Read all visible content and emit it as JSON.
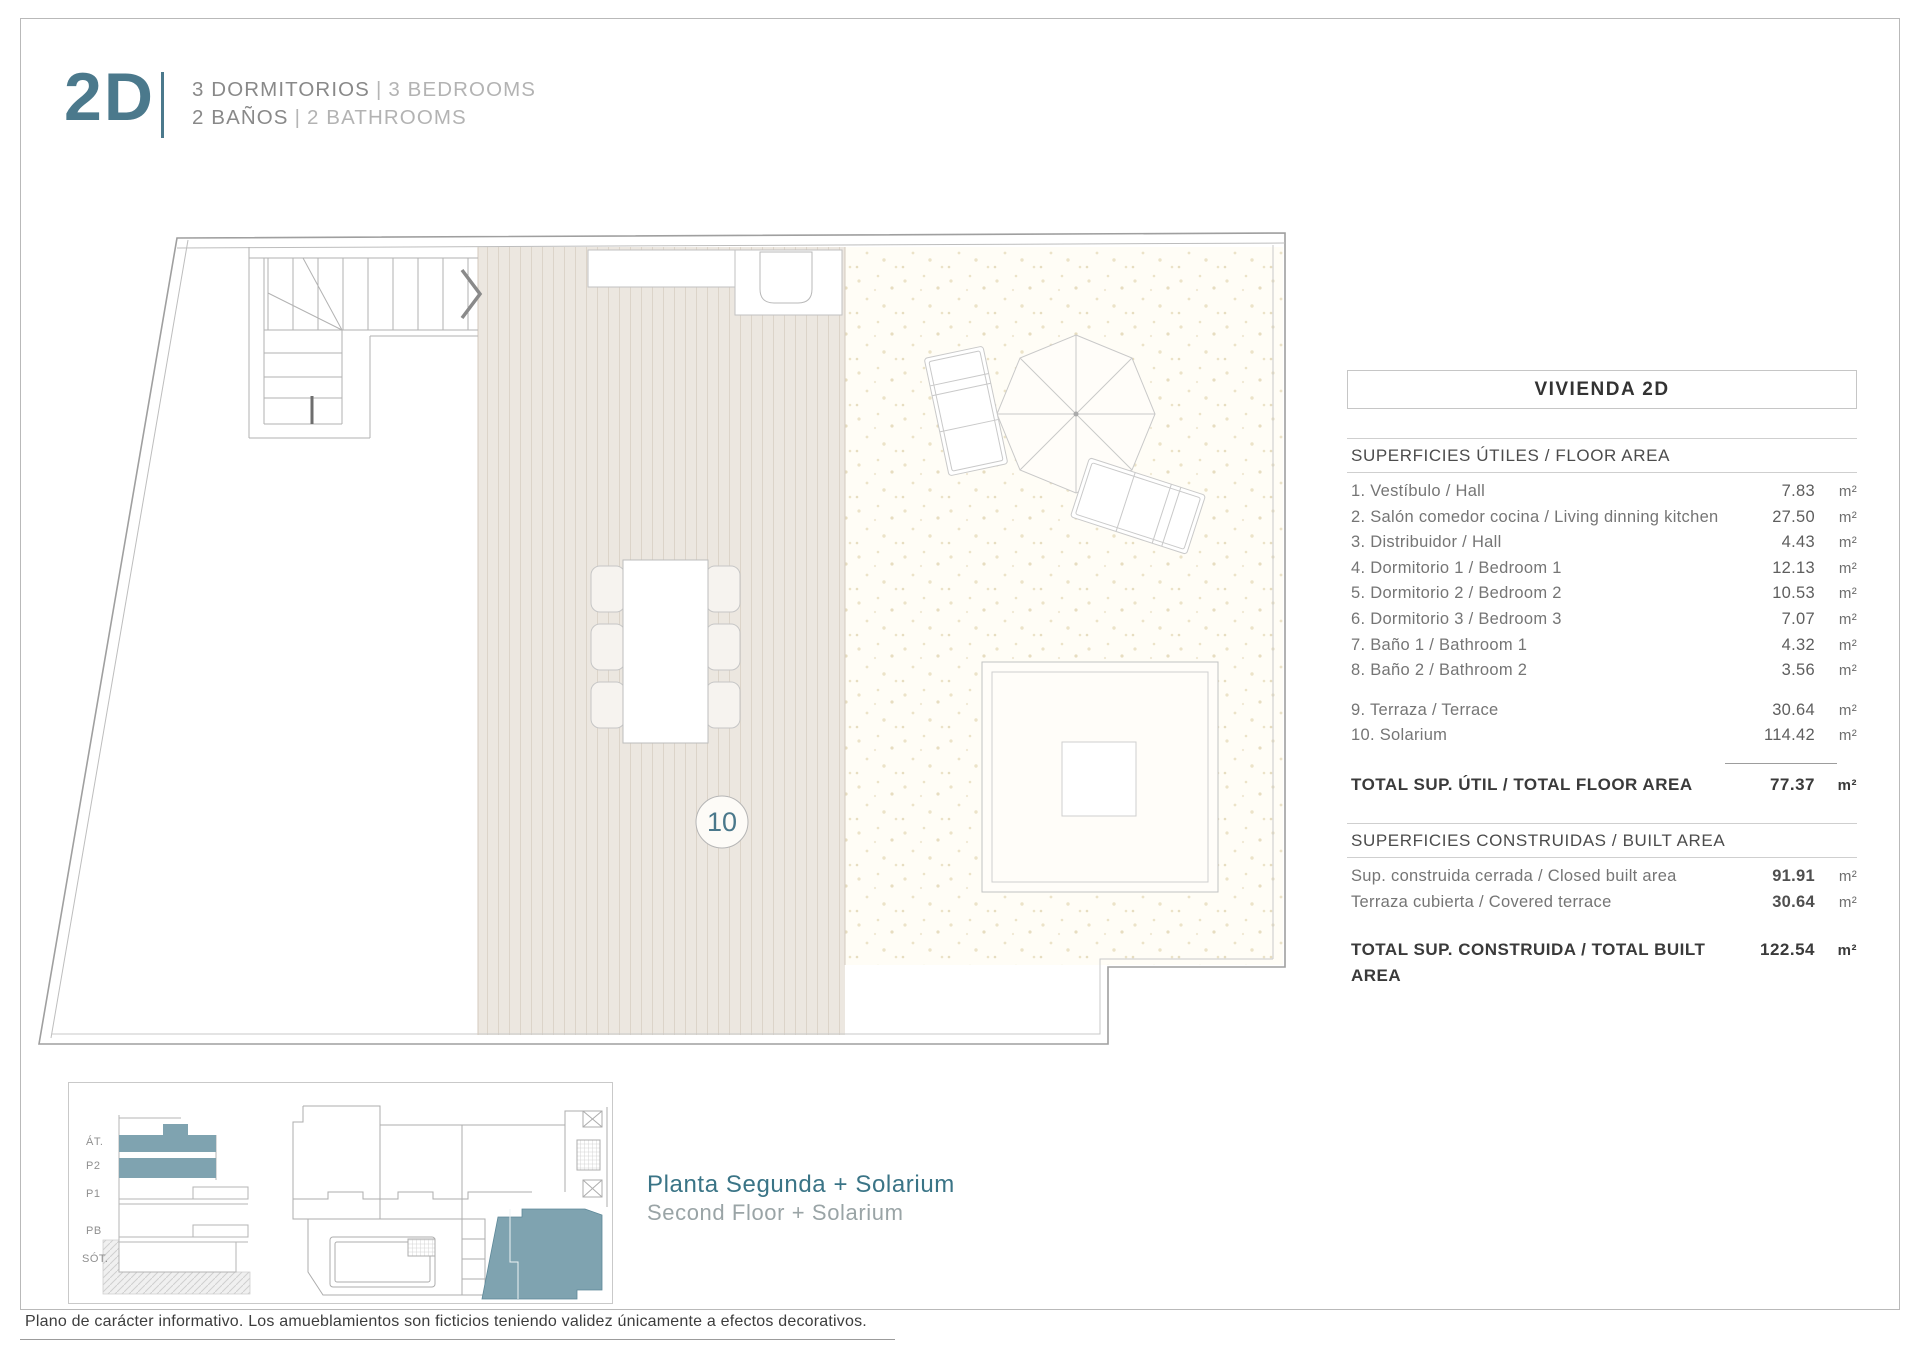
{
  "header": {
    "unit_code": "2D",
    "line1_es": "3 DORMITORIOS",
    "line1_en": "3 BEDROOMS",
    "line2_es": "2 BAÑOS",
    "line2_en": "2 BATHROOMS",
    "separator": "|"
  },
  "plan": {
    "room_label": "10"
  },
  "table": {
    "title": "VIVIENDA 2D",
    "floor_area": {
      "header": "SUPERFICIES ÚTILES / FLOOR AREA",
      "rooms": [
        {
          "label": "1. Vestíbulo / Hall",
          "value": "7.83",
          "unit": "m²"
        },
        {
          "label": "2. Salón comedor cocina / Living dinning kitchen",
          "value": "27.50",
          "unit": "m²"
        },
        {
          "label": "3. Distribuidor / Hall",
          "value": "4.43",
          "unit": "m²"
        },
        {
          "label": "4. Dormitorio 1 / Bedroom 1",
          "value": "12.13",
          "unit": "m²"
        },
        {
          "label": "5. Dormitorio 2 / Bedroom 2",
          "value": "10.53",
          "unit": "m²"
        },
        {
          "label": "6. Dormitorio 3 / Bedroom 3",
          "value": "7.07",
          "unit": "m²"
        },
        {
          "label": "7. Baño 1 / Bathroom 1",
          "value": "4.32",
          "unit": "m²"
        },
        {
          "label": "8. Baño 2 / Bathroom 2",
          "value": "3.56",
          "unit": "m²"
        }
      ],
      "outdoor": [
        {
          "label": "9. Terraza / Terrace",
          "value": "30.64",
          "unit": "m²"
        },
        {
          "label": "10. Solarium",
          "value": "114.42",
          "unit": "m²"
        }
      ],
      "total_label": "TOTAL SUP. ÚTIL / TOTAL FLOOR AREA",
      "total_value": "77.37",
      "total_unit": "m²"
    },
    "built_area": {
      "header": "SUPERFICIES CONSTRUIDAS / BUILT AREA",
      "rows": [
        {
          "label": "Sup. construida cerrada / Closed built area",
          "value": "91.91",
          "unit": "m²"
        },
        {
          "label": "Terraza cubierta / Covered terrace",
          "value": "30.64",
          "unit": "m²"
        }
      ],
      "total_label": "TOTAL SUP. CONSTRUIDA /  TOTAL BUILT AREA",
      "total_value": "122.54",
      "total_unit": "m²"
    }
  },
  "minimap": {
    "levels": [
      "ÁT.",
      "P2",
      "P1",
      "PB",
      "SÓT."
    ]
  },
  "caption": {
    "title_es": "Planta Segunda + Solarium",
    "title_en": "Second Floor + Solarium"
  },
  "footer": {
    "disclaimer": "Plano de carácter informativo. Los amueblamientos son ficticios teniendo validez únicamente a efectos decorativos."
  },
  "colors": {
    "accent_teal": "#4b798c",
    "minimap_fill": "#7fa3b0",
    "deck_fill": "#ece7e0",
    "dots_fill": "#ece3c8"
  }
}
